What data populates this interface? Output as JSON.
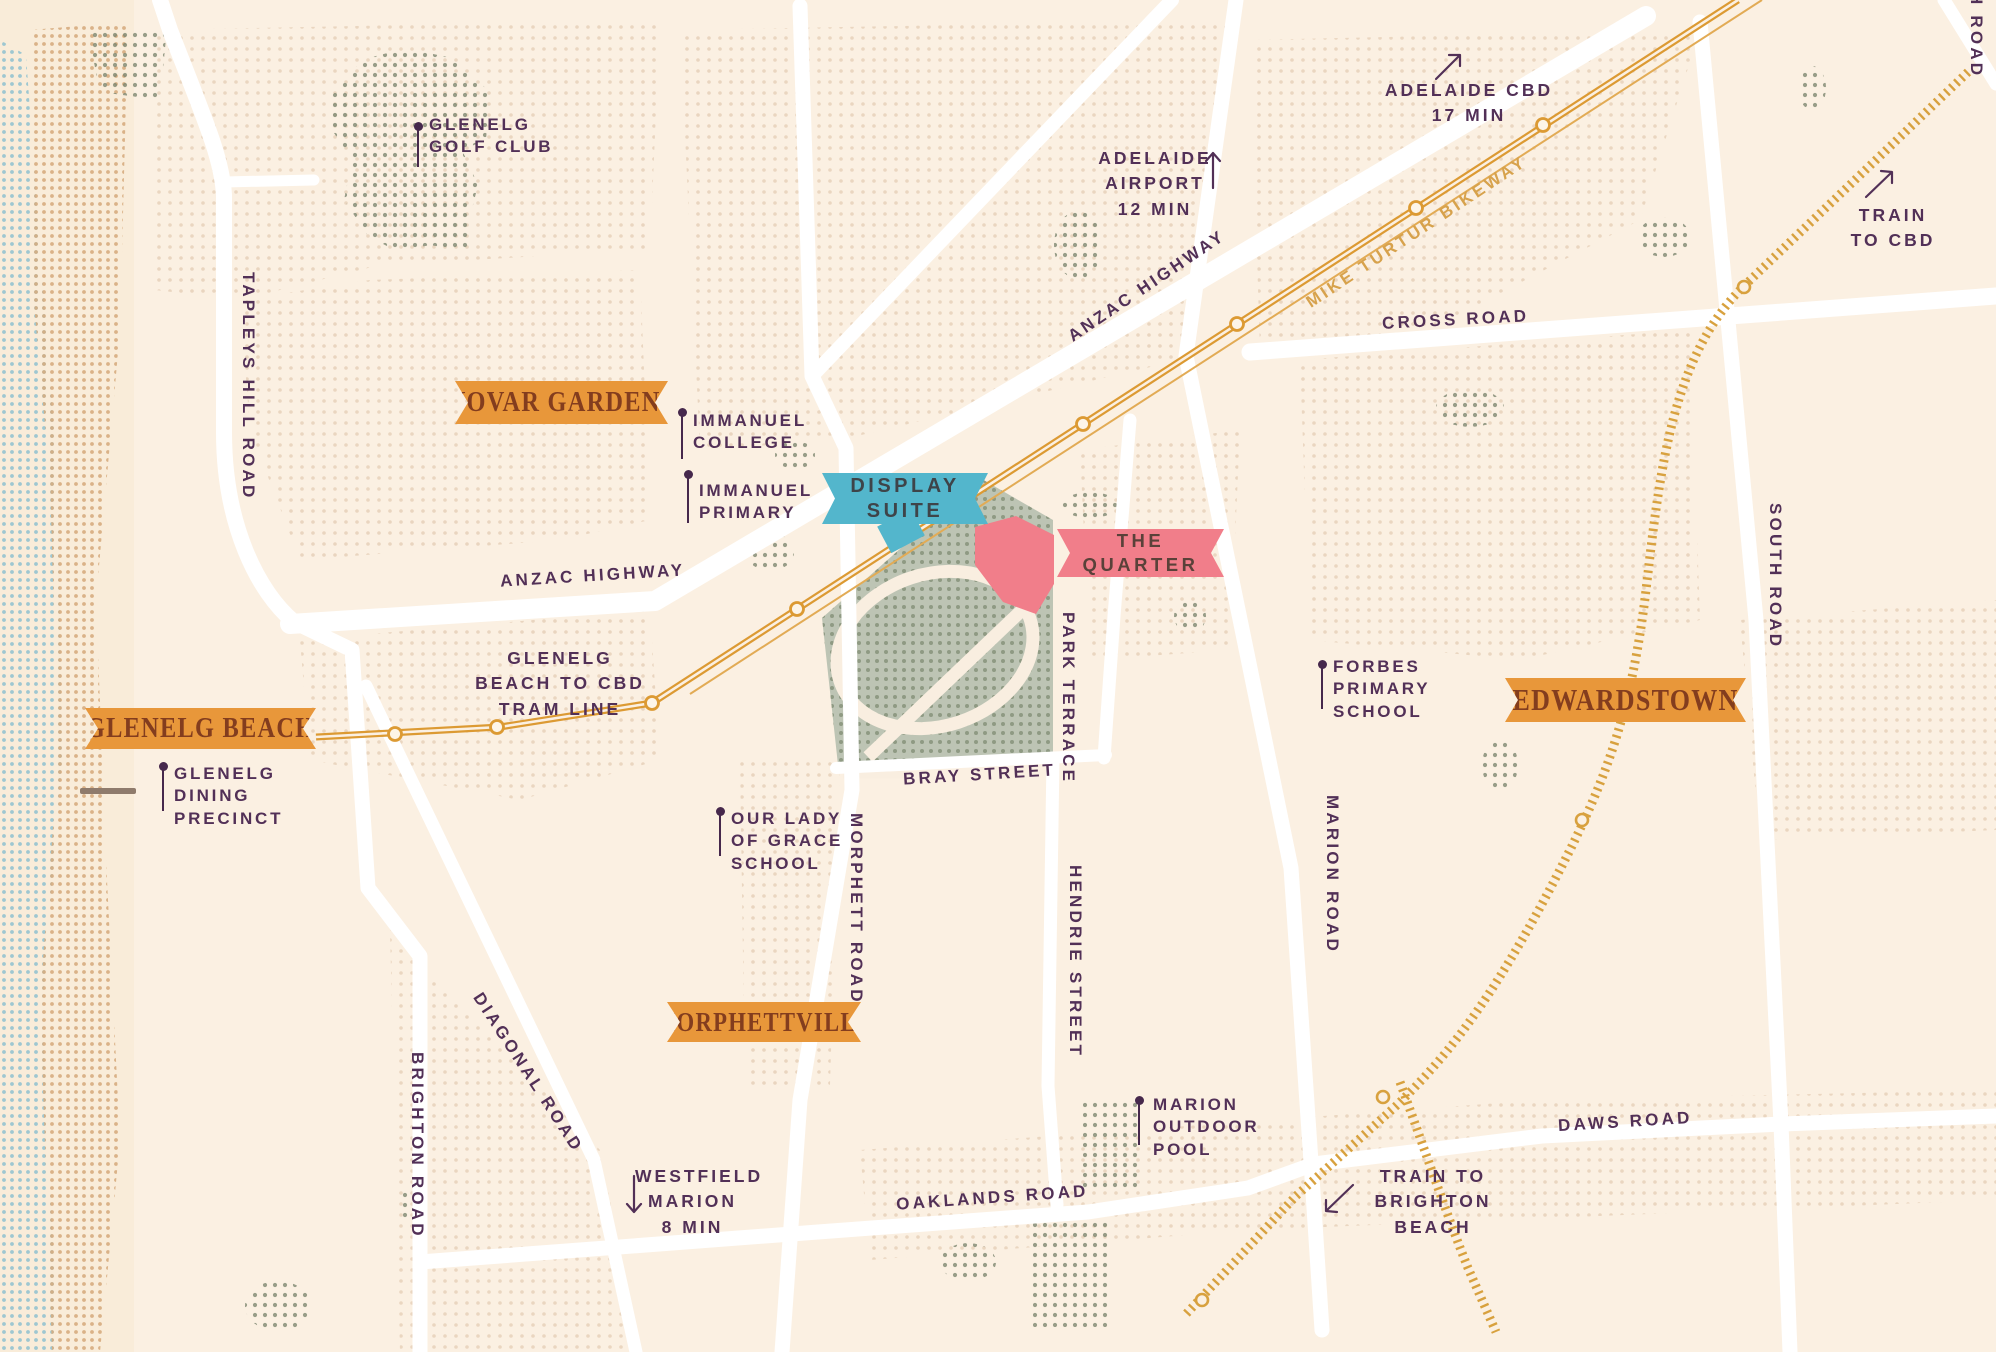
{
  "map_title": "The Quarter location map — Glenelg / Morphettville, Adelaide",
  "colors": {
    "background": "#FBF0E2",
    "banner_orange": "#E8973A",
    "banner_orange_text": "#833D1E",
    "banner_teal": "#53B6CC",
    "banner_pink": "#F17E8A",
    "label_plum": "#523057",
    "pin_plum": "#46284C",
    "road_white": "#FFFFFF",
    "tram_gold": "#DC9A33",
    "train_gold": "#D8A13E",
    "bikeway_gold": "#D7A24C",
    "racecourse_green": "#BDC4B4",
    "beach_blue_dots": "#9EC7D1",
    "beach_sand_dots": "#D7AC7F"
  },
  "suburbs": {
    "novar_gardens": "NOVAR GARDENS",
    "glenelg_beach": "GLENELG BEACH",
    "edwardstown": "EDWARDSTOWN",
    "morphettville": "MORPHETTVILLE"
  },
  "site": {
    "display_suite": {
      "l1": "DISPLAY",
      "l2": "SUITE"
    },
    "the_quarter": {
      "l1": "THE",
      "l2": "QUARTER"
    }
  },
  "roads": {
    "tapleys_hill": "TAPLEYS HILL ROAD",
    "anzac_highway_upper": "ANZAC HIGHWAY",
    "anzac_highway_lower": "ANZAC HIGHWAY",
    "cross_road": "CROSS ROAD",
    "south_road": "SOUTH ROAD",
    "south_road_corner": "SOUTH ROAD",
    "morphett_road": "MORPHETT ROAD",
    "park_terrace": "PARK TERRACE",
    "hendrie_street": "HENDRIE STREET",
    "marion_road": "MARION ROAD",
    "bray_street": "BRAY STREET",
    "brighton_road": "BRIGHTON ROAD",
    "diagonal_road": "DIAGONAL ROAD",
    "oaklands_road": "OAKLANDS ROAD",
    "daws_road": "DAWS ROAD"
  },
  "transit": {
    "tram_label": {
      "l1": "GLENELG",
      "l2": "BEACH TO CBD",
      "l3": "TRAM LINE"
    },
    "bikeway_label": "MIKE TURTUR BIKEWAY"
  },
  "pois": {
    "golf": {
      "l1": "GLENELG",
      "l2": "GOLF CLUB"
    },
    "immanuel_college": {
      "l1": "IMMANUEL",
      "l2": "COLLEGE"
    },
    "immanuel_primary": {
      "l1": "IMMANUEL",
      "l2": "PRIMARY"
    },
    "dining": {
      "l1": "GLENELG",
      "l2": "DINING",
      "l3": "PRECINCT"
    },
    "our_lady": {
      "l1": "OUR LADY",
      "l2": "OF GRACE",
      "l3": "SCHOOL"
    },
    "forbes": {
      "l1": "FORBES",
      "l2": "PRIMARY",
      "l3": "SCHOOL"
    },
    "marion_pool": {
      "l1": "MARION",
      "l2": "OUTDOOR",
      "l3": "POOL"
    }
  },
  "directions": {
    "adelaide_cbd": {
      "l1": "ADELAIDE CBD",
      "l2": "17 MIN"
    },
    "adelaide_airport": {
      "l1": "ADELAIDE",
      "l2": "AIRPORT",
      "l3": "12 MIN"
    },
    "train_cbd": {
      "l1": "TRAIN",
      "l2": "TO CBD"
    },
    "westfield": {
      "l1": "WESTFIELD",
      "l2": "MARION",
      "l3": "8 MIN"
    },
    "train_brighton": {
      "l1": "TRAIN TO",
      "l2": "BRIGHTON",
      "l3": "BEACH"
    }
  }
}
